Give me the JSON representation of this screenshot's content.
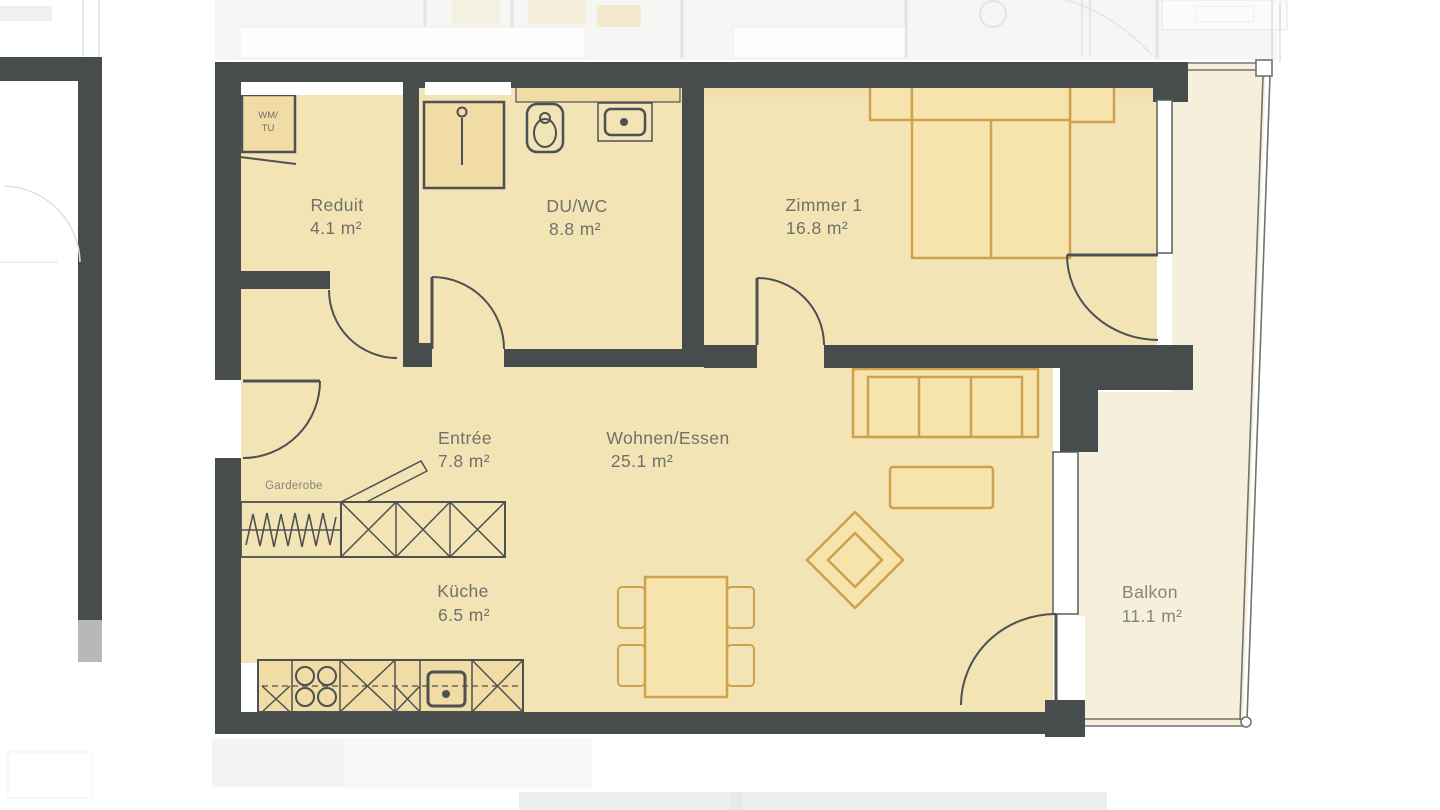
{
  "plan": {
    "title": "Apartment floor plan (2.5 rooms)",
    "rooms": [
      {
        "id": "reduit",
        "name": "Reduit",
        "area": "4.1 m²"
      },
      {
        "id": "duwc",
        "name": "DU/WC",
        "area": "8.8 m²"
      },
      {
        "id": "zimmer1",
        "name": "Zimmer 1",
        "area": "16.8 m²"
      },
      {
        "id": "entree",
        "name": "Entrée",
        "area": "7.8 m²"
      },
      {
        "id": "wohnen",
        "name": "Wohnen/Essen",
        "area": "25.1 m²"
      },
      {
        "id": "kueche",
        "name": "Küche",
        "area": "6.5 m²"
      },
      {
        "id": "balkon",
        "name": "Balkon",
        "area": "11.1 m²"
      }
    ],
    "annotations": {
      "garderobe": "Garderobe",
      "wm_tu_line1": "WM/",
      "wm_tu_line2": "TU"
    },
    "colors": {
      "wall": "#474c4c",
      "floor": "#f3e4b6",
      "balcony_floor": "#f6efdb",
      "furniture_outline": "#cfa14c",
      "fixture_fill": "#f0dca4",
      "label": "#6f7268"
    }
  }
}
